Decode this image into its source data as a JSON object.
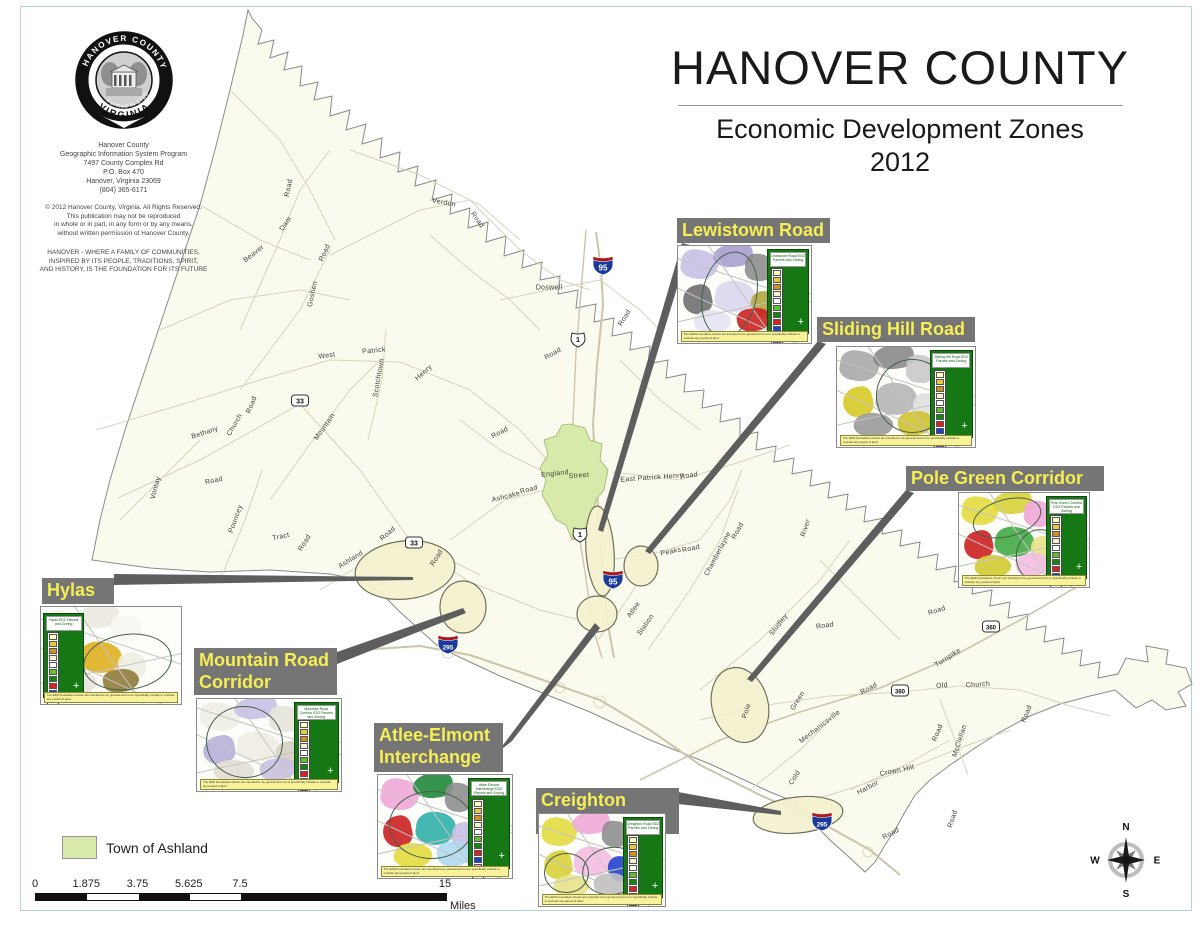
{
  "header": {
    "title": "HANOVER COUNTY",
    "subtitle": "Economic Development Zones",
    "year": "2012"
  },
  "logo": {
    "seal_top": "HANOVER COUNTY",
    "seal_bottom": "VIRGINIA",
    "seal_year": "Formed in 1720",
    "address": "Hanover County\nGeographic Information System Program\n7497 County Complex Rd\nP.O. Box 470\nHanover, Virginia 23069\n(804) 365-6171",
    "copyright": "© 2012 Hanover County, Virginia.  All Rights Reserved.\nThis publication may not be reproduced\nin whole or in part, in any form or by any means,\nwithout written permission of Hanover County.",
    "motto": "HANOVER - WHERE A FAMILY OF COMMUNITIES,\nINSPIRED BY ITS PEOPLE, TRADITIONS, SPIRIT,\nAND HISTORY, IS THE FOUNDATION FOR ITS FUTURE"
  },
  "legend": {
    "swatch_label": "Town of Ashland",
    "swatch_color": "#d7eaaa"
  },
  "scale_bar": {
    "ticks": [
      "0",
      "1.875",
      "3.75",
      "5.625",
      "7.5",
      "15"
    ],
    "values": [
      0,
      1.875,
      3.75,
      5.625,
      7.5,
      15
    ],
    "unit": "Miles",
    "total_miles": 15
  },
  "compass": {
    "n": "N",
    "e": "E",
    "s": "S",
    "w": "W"
  },
  "colors": {
    "label_bar_bg": "#757575",
    "label_text": "#f5ee55",
    "county_fill": "#fbfaee",
    "zone_fill": "#f4f1cf",
    "town_fill": "#d7eaaa",
    "legend_panel_green": "#157815",
    "caption_yellow": "#f8f29a",
    "interstate_blue": "#1a3a9c",
    "interstate_red": "#b01818"
  },
  "legend_swatch_colors": [
    "#ffffbf",
    "#e8c840",
    "#d49020",
    "#f4f0d0",
    "#ffffff",
    "#60c030",
    "#108810",
    "#dd2020",
    "#2040cc",
    "#f0a0d0",
    "#8050b0",
    "#b0b0b0"
  ],
  "zones": [
    {
      "id": "lewistown-road",
      "label": "Lewistown Road",
      "label_box": [
        677,
        218,
        153,
        25
      ],
      "inset_box": [
        677,
        245,
        133,
        97
      ],
      "legend_side": "right",
      "legend_title": "Lewistown Road EDZ Parcels and Zoning",
      "caption": "The EDZ boundaries shown are intended to be general and not to specifically include or exclude any parcel of land.",
      "palette": [
        "#c9c0e6",
        "#a99ed0",
        "#8f8f8f",
        "#6f6f6f",
        "#ddd6ee",
        "#b3a63f",
        "#e8e4f4",
        "#cc2222"
      ],
      "ellipses": [
        {
          "x": 18,
          "y": 5,
          "w": 40,
          "h": 88,
          "rot": 12
        }
      ]
    },
    {
      "id": "sliding-hill-road",
      "label": "Sliding Hill Road",
      "label_box": [
        817,
        317,
        158,
        25
      ],
      "inset_box": [
        836,
        346,
        138,
        100
      ],
      "legend_side": "right",
      "legend_title": "Sliding Hill Road EDZ Parcels and Zoning",
      "caption": "The EDZ boundaries shown are intended to be general and not to specifically include or exclude any parcel of land.",
      "palette": [
        "#a8a8a8",
        "#8a8a8a",
        "#c9c9c9",
        "#d6c926",
        "#b5b5b5",
        "#e0e0e0",
        "#9a9a9a",
        "#cfc22e"
      ],
      "ellipses": [
        {
          "x": 28,
          "y": 12,
          "w": 52,
          "h": 72,
          "rot": 0
        }
      ]
    },
    {
      "id": "pole-green-corridor",
      "label": "Pole Green Corridor",
      "label_box": [
        906,
        466,
        198,
        25
      ],
      "inset_box": [
        958,
        492,
        130,
        94
      ],
      "legend_side": "right",
      "legend_title": "Pole Green Corridor EDZ Parcels and Zoning",
      "caption": "The EDZ boundaries shown are intended to be general and not to specifically include or exclude any parcel of land.",
      "palette": [
        "#e3dc3f",
        "#d8d238",
        "#f0a8d8",
        "#cc2020",
        "#44aa44",
        "#e8e288",
        "#d0ca30",
        "#f4bce0"
      ],
      "ellipses": [
        {
          "x": 10,
          "y": 6,
          "w": 52,
          "h": 38,
          "rot": -15
        },
        {
          "x": 44,
          "y": 38,
          "w": 34,
          "h": 54,
          "rot": 10
        }
      ]
    },
    {
      "id": "hylas",
      "label": "Hylas",
      "label_box": [
        42,
        578,
        72,
        26
      ],
      "inset_box": [
        40,
        606,
        140,
        97
      ],
      "legend_side": "left",
      "legend_title": "Hylas EDZ Parcels and Zoning",
      "caption": "The EDZ boundaries shown are intended to be general and not to specifically include or exclude any parcel of land.",
      "palette": [
        "#f4f2ea",
        "#eceadf",
        "#f8f6f0",
        "#cc2020",
        "#e0b020",
        "#f0eee4",
        "#e8e6da",
        "#8f7b3a"
      ],
      "ellipses": [
        {
          "x": 30,
          "y": 28,
          "w": 62,
          "h": 56,
          "rot": -8
        }
      ]
    },
    {
      "id": "mountain-road-corridor",
      "label": "Mountain Road\nCorridor",
      "label_box": [
        194,
        648,
        143,
        47
      ],
      "inset_box": [
        196,
        698,
        144,
        92
      ],
      "legend_side": "right",
      "legend_title": "Mountain Road Corridor EDZ Parcels and Zoning",
      "caption": "The EDZ boundaries shown are intended to be general and not to specifically include or exclude any parcel of land.",
      "palette": [
        "#f0eee6",
        "#c9c0e6",
        "#e6e3d9",
        "#b8b0d8",
        "#efece2",
        "#d6cfc0",
        "#e2ded2",
        "#cabfe2"
      ],
      "ellipses": [
        {
          "x": 6,
          "y": 8,
          "w": 52,
          "h": 76,
          "rot": 8
        }
      ]
    },
    {
      "id": "atlee-elmont-interchange",
      "label": "Atlee-Elmont\nInterchange",
      "label_box": [
        374,
        723,
        129,
        49
      ],
      "inset_box": [
        377,
        774,
        134,
        103
      ],
      "legend_side": "right",
      "legend_title": "Atlee-Elmont Interchange EDZ Parcels and Zoning",
      "caption": "The EDZ boundaries shown are intended to be general and not to specifically include or exclude any parcel of land.",
      "palette": [
        "#f0a8d8",
        "#208838",
        "#8f8f8f",
        "#cc2020",
        "#30b0a8",
        "#c9c0e6",
        "#e3dc3f",
        "#b0d8f0"
      ],
      "ellipses": [
        {
          "x": 8,
          "y": 16,
          "w": 62,
          "h": 64,
          "rot": 0
        }
      ]
    },
    {
      "id": "creighton-road",
      "label": "Creighton Road",
      "label_box": [
        536,
        788,
        143,
        25
      ],
      "inset_box": [
        538,
        813,
        126,
        92
      ],
      "legend_side": "right",
      "legend_title": "Creighton Road EDZ Parcels and Zoning",
      "caption": "The EDZ boundaries shown are intended to be general and not to specifically include or exclude any parcel of land.",
      "palette": [
        "#e3dc3f",
        "#f0a8d8",
        "#8f8f8f",
        "#d8d238",
        "#f4bce0",
        "#2244cc",
        "#e8e288",
        "#c0c0c0"
      ],
      "ellipses": [
        {
          "x": 4,
          "y": 42,
          "w": 34,
          "h": 42,
          "rot": 0
        },
        {
          "x": 34,
          "y": 36,
          "w": 46,
          "h": 50,
          "rot": -10
        }
      ]
    }
  ],
  "road_labels": [
    {
      "t": "Road",
      "x": 289,
      "y": 188,
      "r": -78
    },
    {
      "t": "Verdon",
      "x": 444,
      "y": 203,
      "r": 10
    },
    {
      "t": "Road",
      "x": 477,
      "y": 220,
      "r": 55
    },
    {
      "t": "Dam",
      "x": 286,
      "y": 224,
      "r": -55
    },
    {
      "t": "Beaver",
      "x": 254,
      "y": 254,
      "r": -38
    },
    {
      "t": "Road",
      "x": 325,
      "y": 253,
      "r": -65
    },
    {
      "t": "Goshen",
      "x": 313,
      "y": 294,
      "r": -78
    },
    {
      "t": "Doswell",
      "x": 549,
      "y": 288,
      "r": 0
    },
    {
      "t": "Road",
      "x": 625,
      "y": 318,
      "r": -58
    },
    {
      "t": "West",
      "x": 327,
      "y": 356,
      "r": -8
    },
    {
      "t": "Patrick",
      "x": 374,
      "y": 351,
      "r": -5
    },
    {
      "t": "Scotchtown",
      "x": 379,
      "y": 378,
      "r": -80
    },
    {
      "t": "Henry",
      "x": 424,
      "y": 373,
      "r": -42
    },
    {
      "t": "Road",
      "x": 553,
      "y": 354,
      "r": -30
    },
    {
      "t": "Bethany",
      "x": 205,
      "y": 433,
      "r": -18
    },
    {
      "t": "Church",
      "x": 235,
      "y": 425,
      "r": -60
    },
    {
      "t": "Road",
      "x": 252,
      "y": 405,
      "r": -68
    },
    {
      "t": "Mountain",
      "x": 325,
      "y": 427,
      "r": -55
    },
    {
      "t": "Road",
      "x": 500,
      "y": 433,
      "r": -28
    },
    {
      "t": "Vontay",
      "x": 156,
      "y": 488,
      "r": -75
    },
    {
      "t": "Road",
      "x": 214,
      "y": 481,
      "r": -12
    },
    {
      "t": "Pouncey",
      "x": 236,
      "y": 519,
      "r": -70
    },
    {
      "t": "Tract",
      "x": 281,
      "y": 537,
      "r": -12
    },
    {
      "t": "Road",
      "x": 305,
      "y": 543,
      "r": -58
    },
    {
      "t": "Ashland",
      "x": 351,
      "y": 560,
      "r": -32
    },
    {
      "t": "Road",
      "x": 388,
      "y": 534,
      "r": -40
    },
    {
      "t": "Road",
      "x": 437,
      "y": 558,
      "r": -58
    },
    {
      "t": "England",
      "x": 555,
      "y": 474,
      "r": -6
    },
    {
      "t": "Street",
      "x": 579,
      "y": 476,
      "r": -4
    },
    {
      "t": "Ashcake",
      "x": 506,
      "y": 497,
      "r": -14
    },
    {
      "t": "Road",
      "x": 529,
      "y": 490,
      "r": -14
    },
    {
      "t": "East Patrick Henry",
      "x": 652,
      "y": 478,
      "r": -4
    },
    {
      "t": "Road",
      "x": 689,
      "y": 476,
      "r": -8
    },
    {
      "t": "Peaks",
      "x": 671,
      "y": 552,
      "r": -12
    },
    {
      "t": "Road",
      "x": 691,
      "y": 549,
      "r": -12
    },
    {
      "t": "Chamberlayne",
      "x": 718,
      "y": 554,
      "r": -62
    },
    {
      "t": "Road",
      "x": 738,
      "y": 531,
      "r": -62
    },
    {
      "t": "River",
      "x": 806,
      "y": 528,
      "r": -72
    },
    {
      "t": "Atlee",
      "x": 634,
      "y": 610,
      "r": -55
    },
    {
      "t": "Station",
      "x": 646,
      "y": 625,
      "r": -55
    },
    {
      "t": "Studley",
      "x": 779,
      "y": 625,
      "r": -52
    },
    {
      "t": "Road",
      "x": 825,
      "y": 626,
      "r": -8
    },
    {
      "t": "Road",
      "x": 937,
      "y": 611,
      "r": -18
    },
    {
      "t": "Turnpike",
      "x": 948,
      "y": 658,
      "r": -33
    },
    {
      "t": "Old",
      "x": 942,
      "y": 686,
      "r": -4
    },
    {
      "t": "Church",
      "x": 978,
      "y": 685,
      "r": -4
    },
    {
      "t": "Road",
      "x": 1027,
      "y": 714,
      "r": -68
    },
    {
      "t": "Road",
      "x": 869,
      "y": 689,
      "r": -28
    },
    {
      "t": "Green",
      "x": 798,
      "y": 701,
      "r": -58
    },
    {
      "t": "Pole",
      "x": 747,
      "y": 711,
      "r": -72
    },
    {
      "t": "Mechanicsville",
      "x": 820,
      "y": 727,
      "r": -38
    },
    {
      "t": "Road",
      "x": 938,
      "y": 733,
      "r": -68
    },
    {
      "t": "McClellan",
      "x": 960,
      "y": 741,
      "r": -72
    },
    {
      "t": "Crown Hill",
      "x": 897,
      "y": 771,
      "r": -12
    },
    {
      "t": "Harbor",
      "x": 868,
      "y": 788,
      "r": -28
    },
    {
      "t": "Cold",
      "x": 795,
      "y": 778,
      "r": -58
    },
    {
      "t": "Road",
      "x": 953,
      "y": 819,
      "r": -72
    },
    {
      "t": "Road",
      "x": 891,
      "y": 834,
      "r": -28
    }
  ],
  "shields": [
    {
      "type": "interstate",
      "num": "95",
      "x": 603,
      "y": 268
    },
    {
      "type": "interstate",
      "num": "95",
      "x": 613,
      "y": 582
    },
    {
      "type": "interstate",
      "num": "295",
      "x": 448,
      "y": 647
    },
    {
      "type": "interstate",
      "num": "295",
      "x": 822,
      "y": 824
    },
    {
      "type": "us",
      "num": "1",
      "x": 578,
      "y": 342
    },
    {
      "type": "us",
      "num": "1",
      "x": 580,
      "y": 537
    },
    {
      "type": "state",
      "num": "33",
      "x": 300,
      "y": 403
    },
    {
      "type": "state",
      "num": "33",
      "x": 414,
      "y": 545
    },
    {
      "type": "state",
      "num": "360",
      "x": 991,
      "y": 629
    },
    {
      "type": "state",
      "num": "360",
      "x": 900,
      "y": 693
    }
  ]
}
